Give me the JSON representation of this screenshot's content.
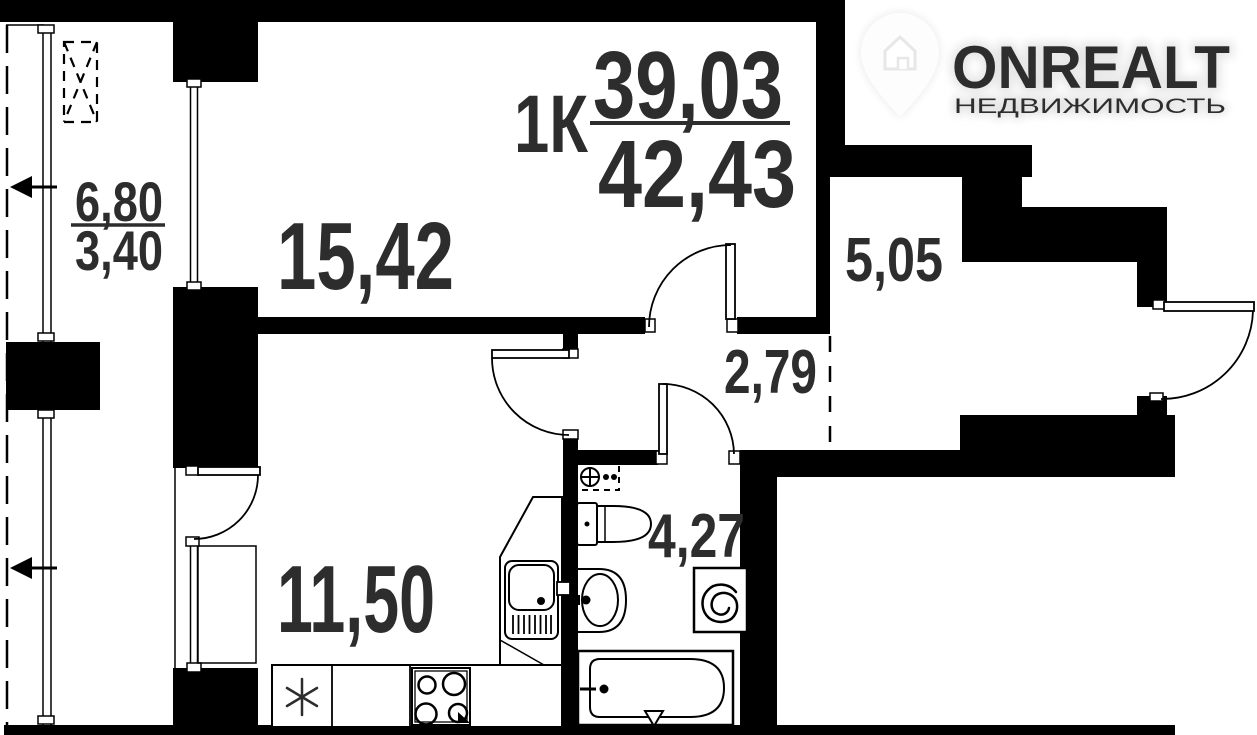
{
  "meta": {
    "type": "apartment-floor-plan"
  },
  "watermark": {
    "brand": "ONREALT",
    "tagline": "НЕДВИЖИМОСТЬ"
  },
  "title": {
    "rooms": "1К",
    "area_upper": "39,03",
    "area_lower": "42,43"
  },
  "rooms": {
    "living_room": {
      "area": "15,42"
    },
    "kitchen": {
      "area": "11,50"
    },
    "hallway": {
      "area": "5,05"
    },
    "corridor": {
      "area": "2,79"
    },
    "bathroom": {
      "area": "4,27"
    },
    "balcony": {
      "area_full": "6,80",
      "area_half": "3,40"
    }
  },
  "colors": {
    "wall": "#000000",
    "text": "#2d2d2d",
    "background": "#ffffff",
    "watermark": "#e9e9e9"
  }
}
